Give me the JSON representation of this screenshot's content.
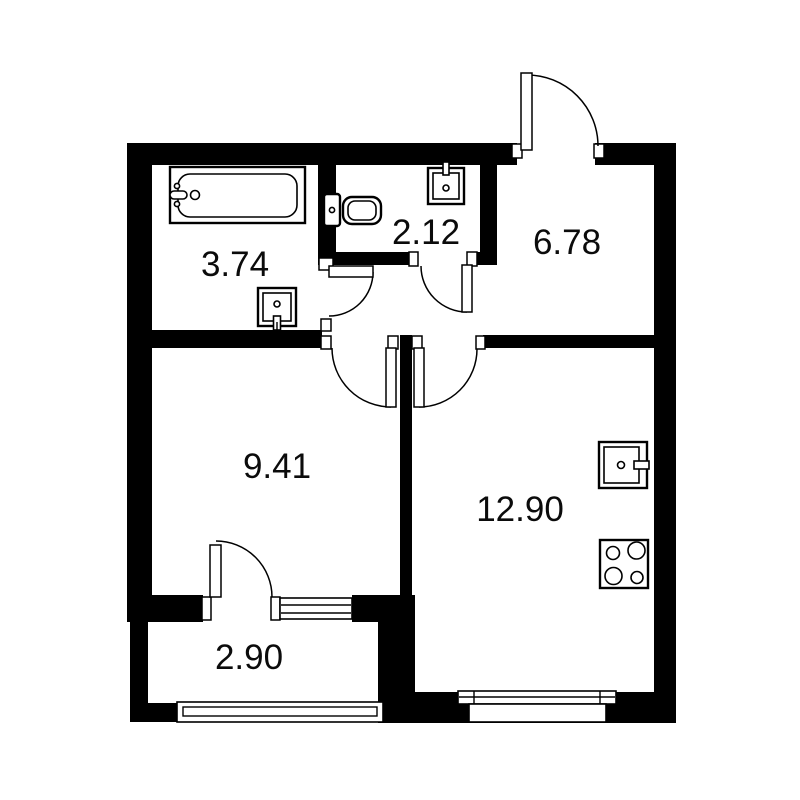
{
  "floor_plan": {
    "type": "apartment-floor-plan",
    "colors": {
      "wall": "#000000",
      "background": "#ffffff",
      "line": "#000000",
      "label": "#0b0b0b"
    },
    "rooms": [
      {
        "name": "bathroom",
        "area": "3.74",
        "fixtures": [
          "bathtub-icon",
          "washbasin-icon"
        ]
      },
      {
        "name": "toilet-room",
        "area": "2.12",
        "fixtures": [
          "toilet-icon",
          "washbasin-icon"
        ]
      },
      {
        "name": "hallway",
        "area": "6.78",
        "fixtures": []
      },
      {
        "name": "bedroom",
        "area": "9.41",
        "fixtures": []
      },
      {
        "name": "kitchen-living",
        "area": "12.90",
        "fixtures": [
          "kitchen-sink-icon",
          "stove-icon"
        ]
      },
      {
        "name": "balcony",
        "area": "2.90",
        "fixtures": []
      }
    ],
    "doors": [
      "entrance-door",
      "bathroom-door",
      "toilet-door",
      "bedroom-door",
      "kitchen-door",
      "balcony-door"
    ],
    "windows": [
      "bedroom-balcony-window",
      "balcony-glazing",
      "kitchen-window"
    ]
  }
}
